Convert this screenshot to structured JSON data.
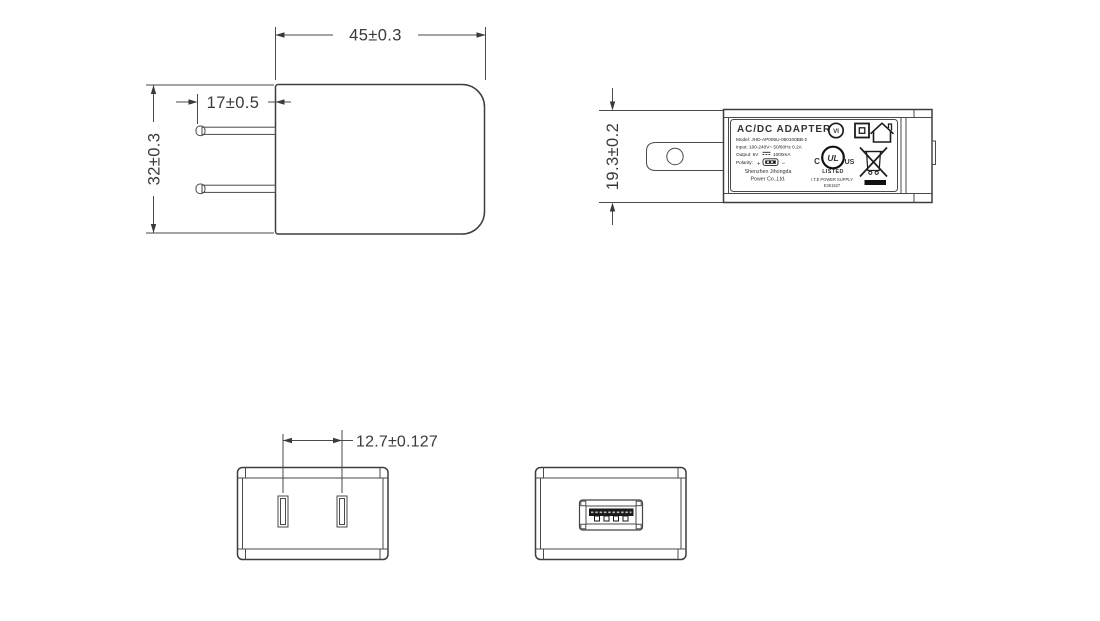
{
  "drawing": {
    "dimensions": {
      "body_width": "45±0.3",
      "prong_length": "17±0.5",
      "body_height": "32±0.3",
      "body_thickness": "19.3±0.2",
      "pin_pitch": "12.7±0.127"
    },
    "label": {
      "title": "AC/DC  ADAPTER",
      "model": "Model: JHD-AP006U-050100BB-2",
      "input": "Input: 100-240V~ 50/60Hz 0.2A",
      "output_prefix": "Output: 5V",
      "output_suffix": "1000mA",
      "polarity_label": "Polarity:",
      "polarity_plus": "+",
      "polarity_minus": "−",
      "company_line1": "Shenzhen Jihongda",
      "company_line2": "Power Co.,Ltd.",
      "efficiency_mark": "VI",
      "ul_c": "C",
      "ul_letters": "UL",
      "ul_us": "US",
      "ul_listed": "LISTED",
      "ul_line1": "I.T.E POWER SUPPLY",
      "ul_line2": "E361527"
    },
    "colors": {
      "line": "#4a4a4a",
      "text": "#333333"
    }
  }
}
